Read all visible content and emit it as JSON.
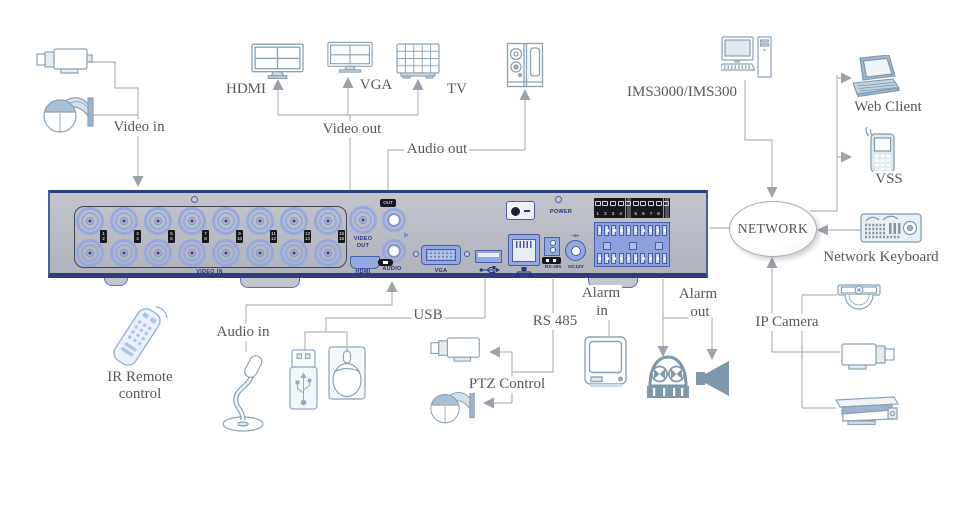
{
  "title": "DVR rear panel connection diagram",
  "colors": {
    "line": "#b5b5b5",
    "arrow": "#9aa2ab",
    "icon_stroke": "#8ba2b4",
    "icon_solid": "#7d98ab",
    "panel_body": "#b6b9c1",
    "panel_border_dark": "#2e3d7d",
    "connector_blue": "#94a9e2",
    "connector_border": "#4c5ca6",
    "panel_text": "#26357c",
    "label_text": "#55595e"
  },
  "labels": {
    "video_in": "Video in",
    "video_out": "Video out",
    "audio_out": "Audio out",
    "audio_in": "Audio in",
    "hdmi": "HDMI",
    "vga": "VGA",
    "tv": "TV",
    "ims": "IMS3000/IMS300",
    "web_client": "Web Client",
    "vss": "VSS",
    "network": "NETWORK",
    "network_keyboard": "Network Keyboard",
    "ip_camera": "IP Camera",
    "ir_remote1": "IR Remote",
    "ir_remote2": "control",
    "usb": "USB",
    "rs485": "RS 485",
    "ptz_control": "PTZ Control",
    "alarm_in1": "Alarm",
    "alarm_in2": "in",
    "alarm_out1": "Alarm",
    "alarm_out2": "out"
  },
  "panel": {
    "ports": {
      "video_in": "VIDEO IN",
      "video_out1": "VIDEO",
      "video_out2": "OUT",
      "hdmi": "HDMI",
      "out_tag": "OUT",
      "audio": "AUDIO",
      "vga": "VGA",
      "rs485": "RS-485",
      "dc12v": "DC12V",
      "dc_polarity": "−⊙+",
      "power": "POWER"
    },
    "bnc_pairs": [
      [
        "1",
        "2"
      ],
      [
        "3",
        "4"
      ],
      [
        "5",
        "6"
      ],
      [
        "7",
        "8"
      ],
      [
        "9",
        "10"
      ],
      [
        "11",
        "12"
      ],
      [
        "13",
        "14"
      ],
      [
        "15",
        "16"
      ]
    ],
    "alarm_cells": [
      "1",
      "2",
      "3",
      "4",
      "",
      "5",
      "6",
      "7",
      "8",
      ""
    ]
  },
  "icons": [
    "bullet-camera",
    "ptz-dome-camera",
    "hdmi-monitor",
    "vga-monitor",
    "tv-monitor",
    "speaker",
    "desktop-computer",
    "laptop",
    "mobile-phone",
    "network-keyboard",
    "ip-dome-camera",
    "ip-bullet-camera",
    "ip-housing-camera",
    "ir-remote",
    "microphone",
    "usb-flash-drive",
    "mouse",
    "alarm-sensor-monitor",
    "alarm-beacon",
    "alarm-horn",
    "usb-symbol",
    "ethernet-symbol"
  ]
}
